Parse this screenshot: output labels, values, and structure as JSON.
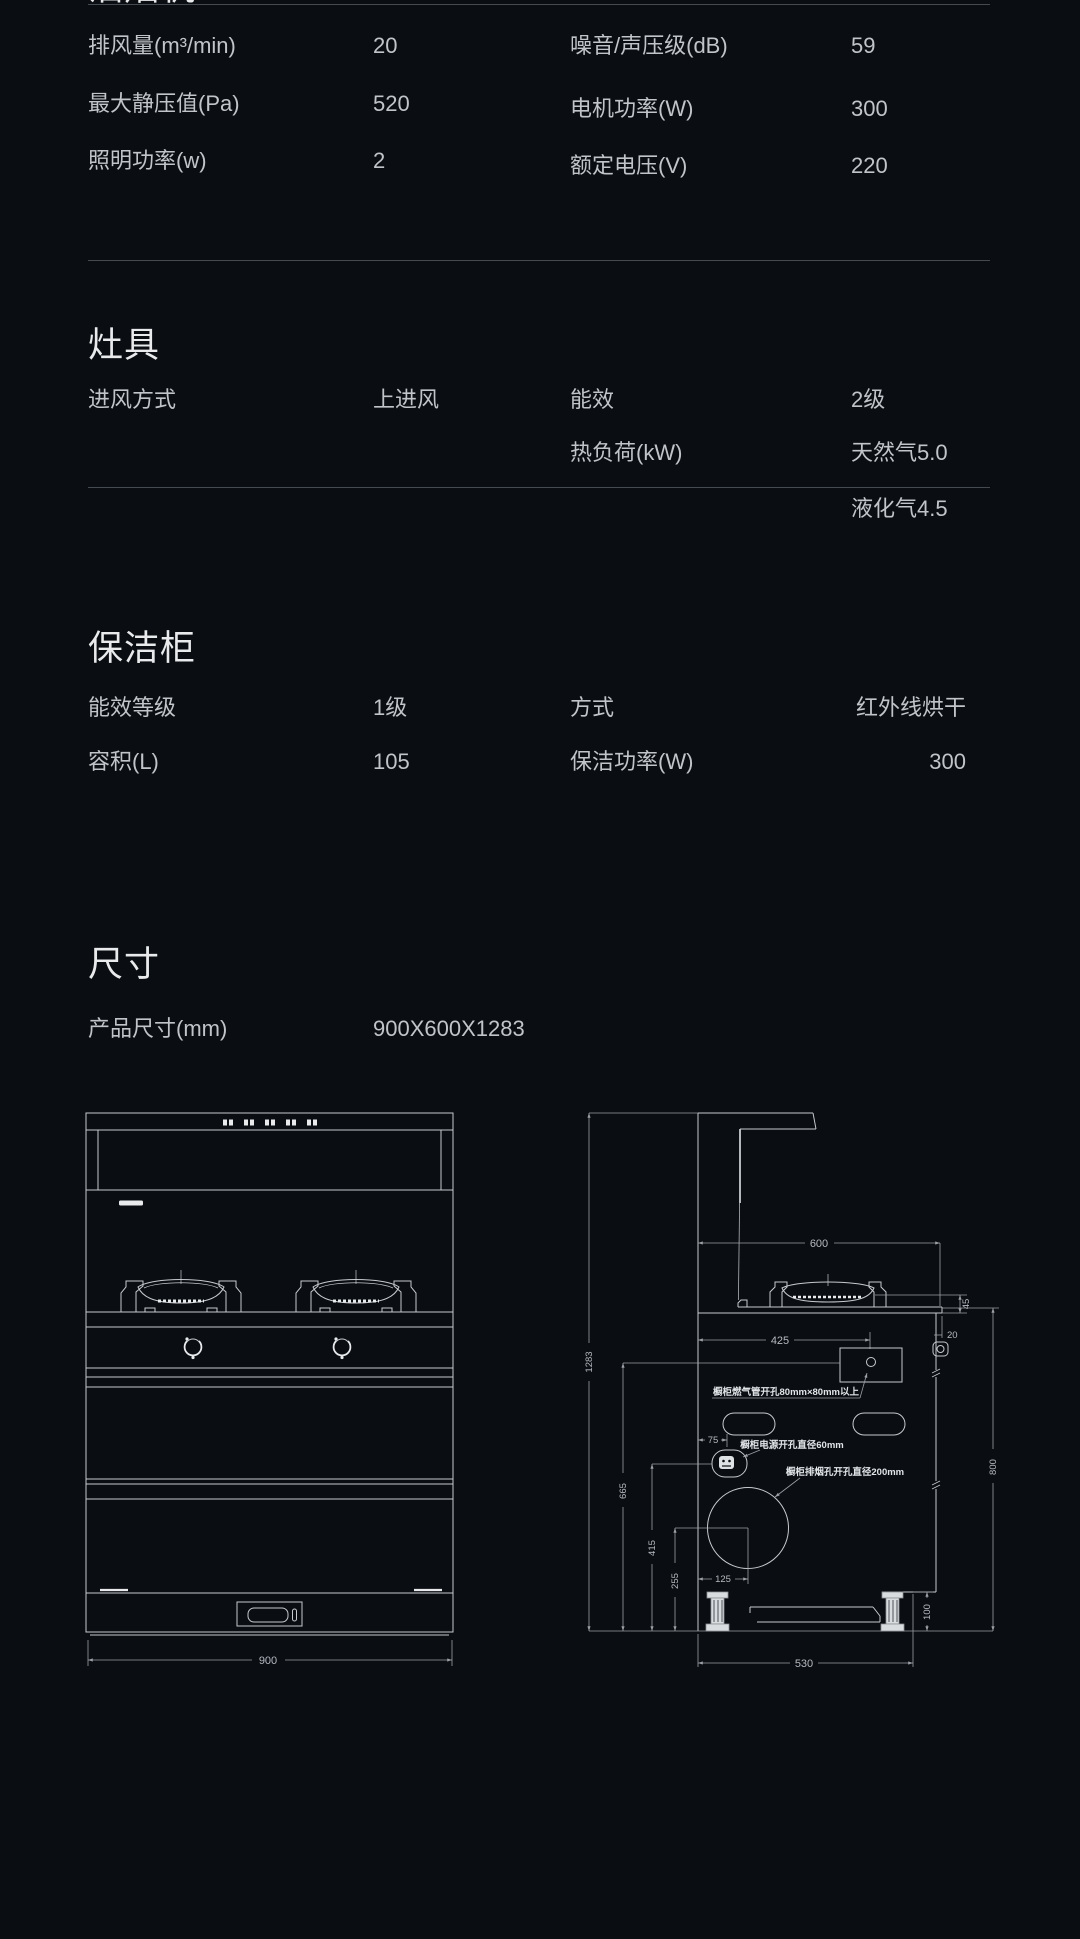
{
  "colors": {
    "background": "#0a0d12",
    "text": "#c1c5c9",
    "heading": "#e8eaec",
    "divider": "#454a51",
    "drawing_line": "#c7cbcf"
  },
  "sections": {
    "hood": {
      "title": "油烟机",
      "left_rows": [
        {
          "label": "排风量(m³/min)",
          "value": "20"
        },
        {
          "label": "最大静压值(Pa)",
          "value": "520"
        },
        {
          "label": "照明功率(w)",
          "value": "2"
        }
      ],
      "right_rows": [
        {
          "label": "噪音/声压级(dB)",
          "value": "59"
        },
        {
          "label": "电机功率(W)",
          "value": "300"
        },
        {
          "label": "额定电压(V)",
          "value": "220"
        }
      ]
    },
    "stove": {
      "title": "灶具",
      "left_rows": [
        {
          "label": "进风方式",
          "value": "上进风"
        }
      ],
      "right_rows": [
        {
          "label": "能效",
          "value": "2级"
        },
        {
          "label": "热负荷(kW)",
          "value": "天然气5.0"
        },
        {
          "label": "",
          "value": "液化气4.5"
        }
      ]
    },
    "cabinet": {
      "title": "保洁柜",
      "left_rows": [
        {
          "label": "能效等级",
          "value": "1级"
        },
        {
          "label": "容积(L)",
          "value": "105"
        }
      ],
      "right_rows": [
        {
          "label": "方式",
          "value": "红外线烘干"
        },
        {
          "label": "保洁功率(W)",
          "value": "300"
        }
      ]
    },
    "size": {
      "title": "尺寸",
      "row": {
        "label": "产品尺寸(mm)",
        "value": "900X600X1283"
      }
    }
  },
  "drawings": {
    "front": {
      "width_label": "900"
    },
    "side": {
      "dims": {
        "top_width": "600",
        "cooktop_height": "45",
        "overhang": "20",
        "depth_425": "425",
        "total_height": "1283",
        "gas_hole_height": "665",
        "power_hole_height": "415",
        "vent_center_height": "255",
        "power_offset": "75",
        "vent_center_offset": "125",
        "foot_height": "100",
        "counter_height": "800",
        "base_depth": "530"
      },
      "notes": {
        "gas": "橱柜燃气管开孔80mm×80mm以上",
        "power": "橱柜电源开孔直径60mm",
        "vent": "橱柜排烟孔开孔直径200mm"
      }
    }
  }
}
